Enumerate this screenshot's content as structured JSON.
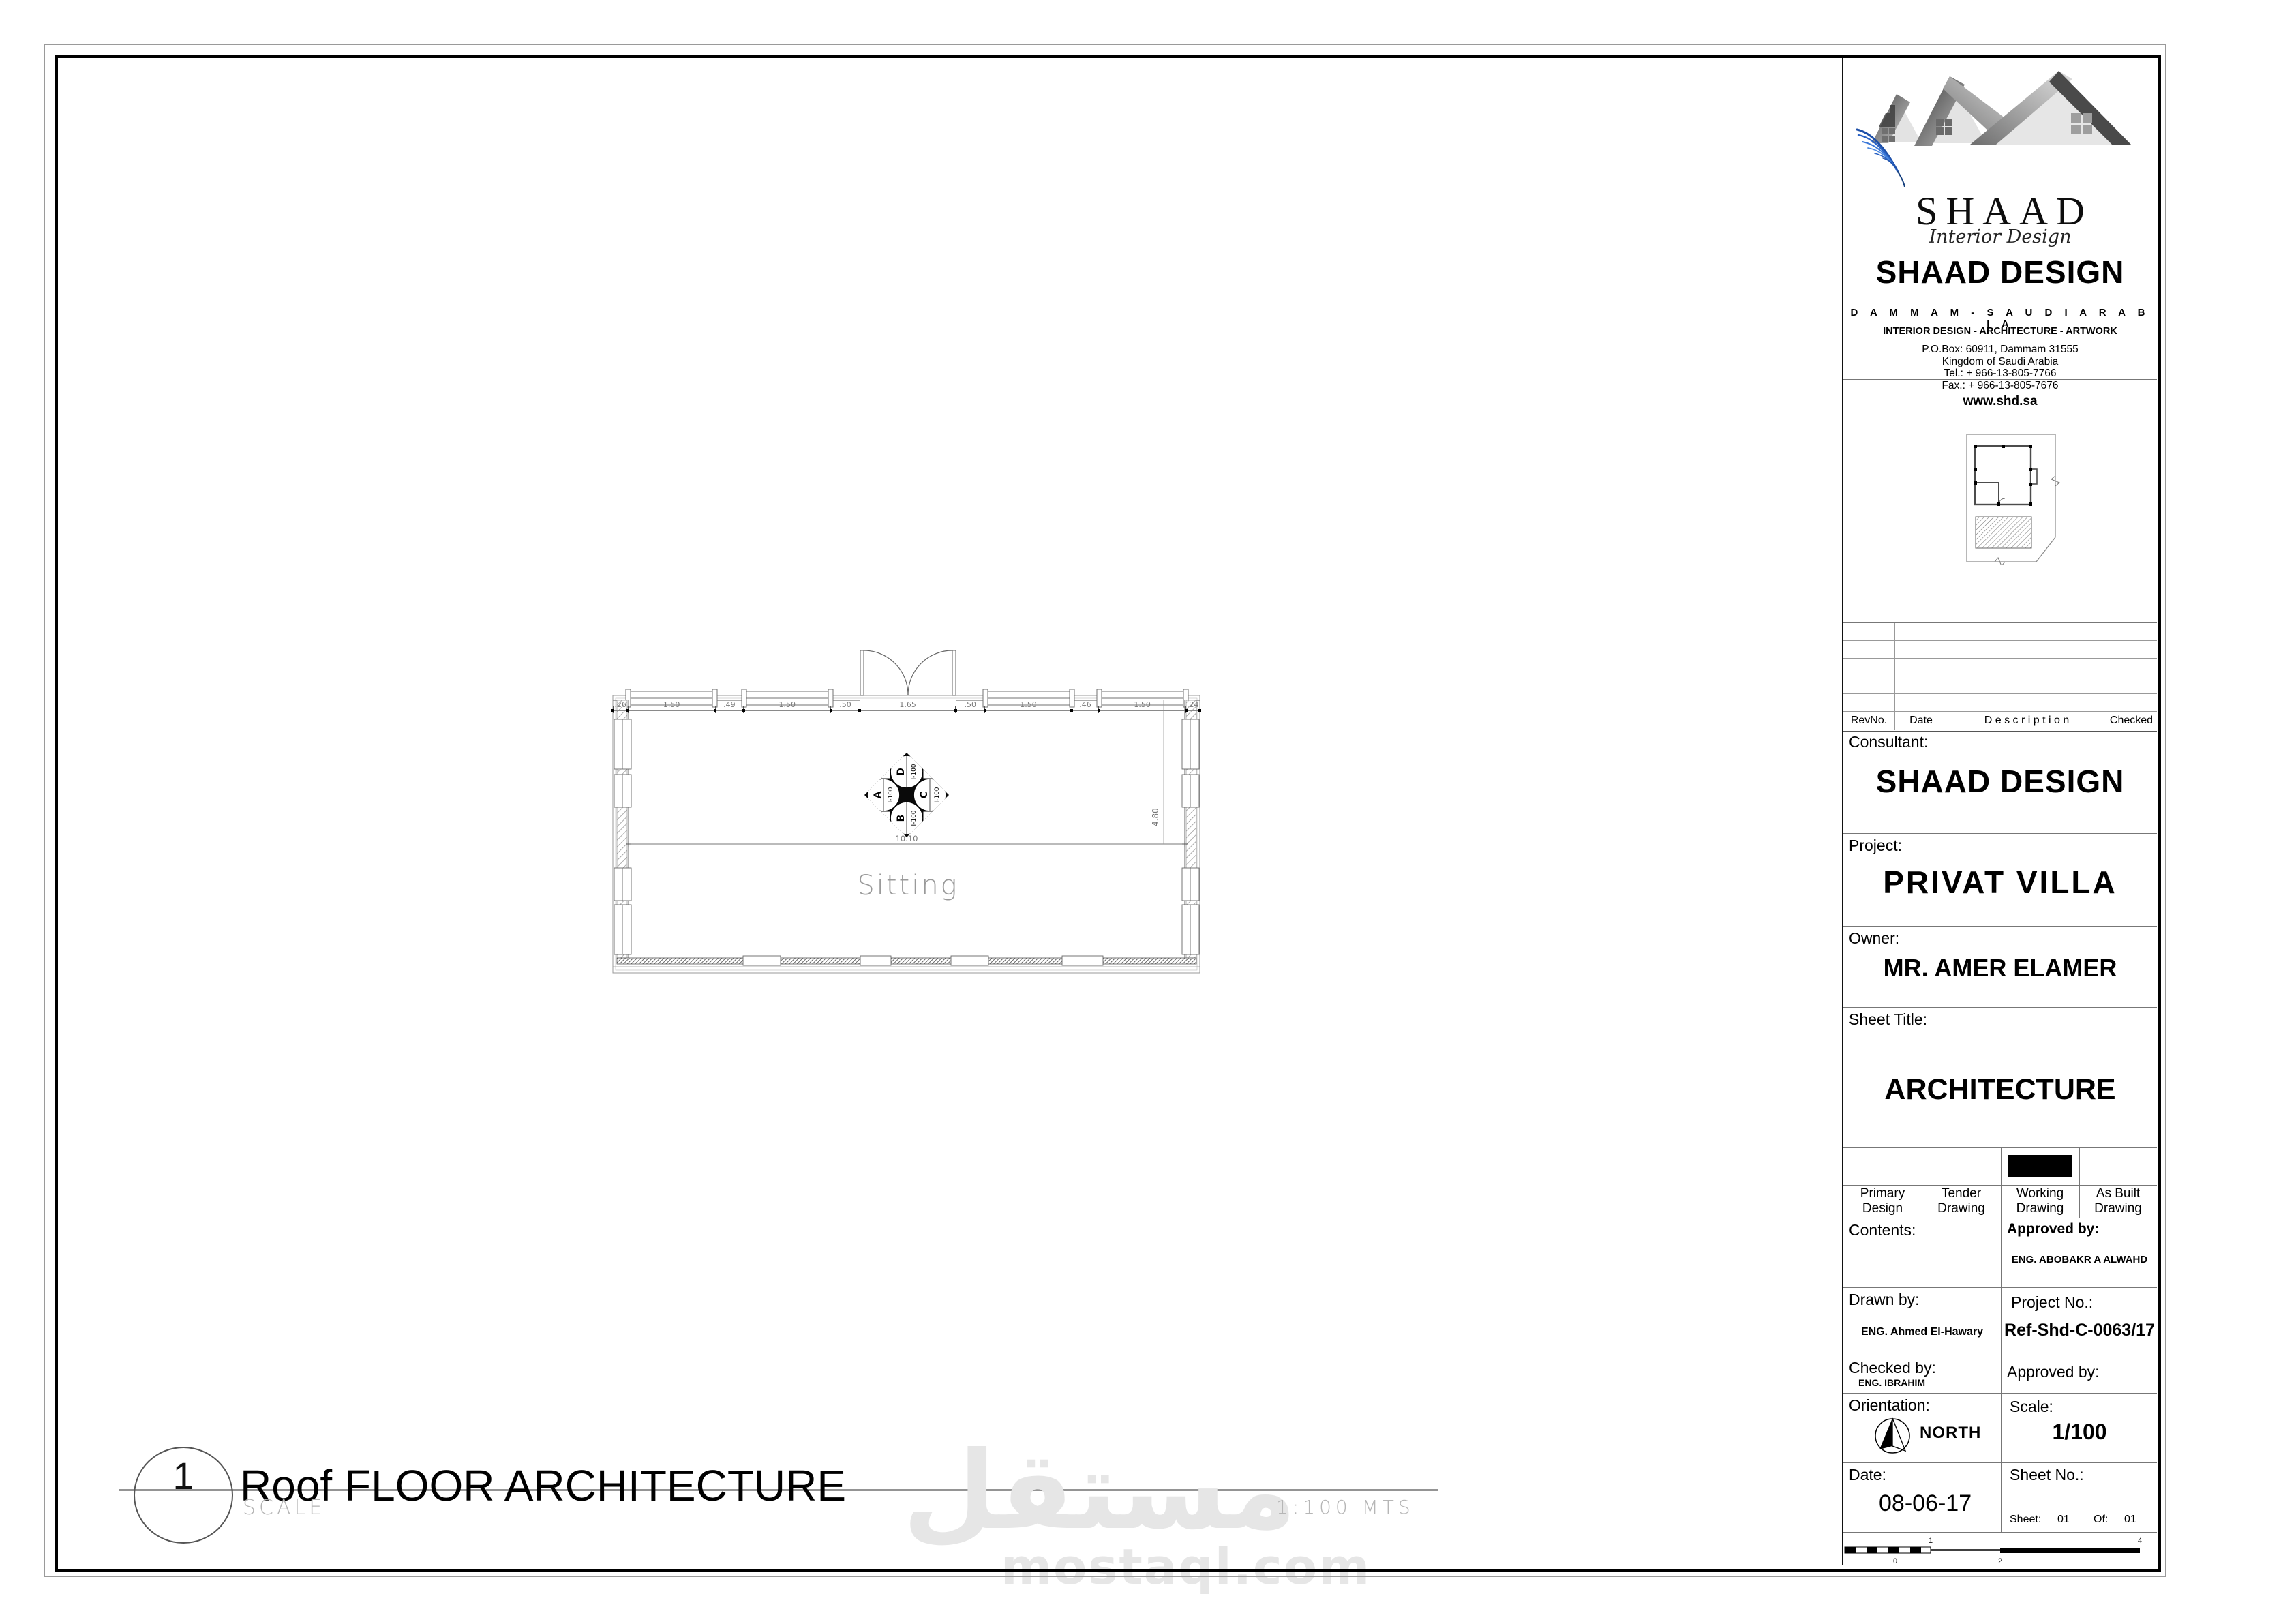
{
  "company": {
    "logo_text": "SHAAD",
    "logo_subtitle": "Interior Design",
    "name": "SHAAD DESIGN",
    "location": "D A M M A M - S A U D I   A R A B I A",
    "services": "INTERIOR DESIGN - ARCHITECTURE - ARTWORK",
    "address_line1": "P.O.Box: 60911, Dammam 31555",
    "address_line2": "Kingdom of Saudi Arabia",
    "address_line3": "Tel.: + 966-13-805-7766",
    "address_line4": "Fax.: + 966-13-805-7676",
    "website": "www.shd.sa"
  },
  "revision_table": {
    "headers": [
      "RevNo.",
      "Date",
      "D e s c r i p t i o n",
      "Checked"
    ]
  },
  "titleblock": {
    "consultant_label": "Consultant:",
    "consultant": "SHAAD DESIGN",
    "project_label": "Project:",
    "project": "PRIVAT VILLA",
    "owner_label": "Owner:",
    "owner": "MR. AMER ELAMER",
    "sheet_title_label": "Sheet Title:",
    "sheet_title": "ARCHITECTURE",
    "drawing_types": [
      "Primary Design",
      "Tender Drawing",
      "Working Drawing",
      "As Built Drawing"
    ],
    "selected_drawing_type": "Working Drawing",
    "contents_label": "Contents:",
    "approved_by_label": "Approved by:",
    "approved_by": "ENG. ABOBAKR A ALWAHD",
    "drawn_by_label": "Drawn by:",
    "drawn_by": "ENG. Ahmed El-Hawary",
    "project_no_label": "Project No.:",
    "project_no": "Ref-Shd-C-0063/17",
    "checked_by_label": "Checked by:",
    "checked_by": "ENG. IBRAHIM",
    "approved_by2_label": "Approved by:",
    "orientation_label": "Orientation:",
    "orientation": "NORTH",
    "scale_label": "Scale:",
    "scale": "1/100",
    "date_label": "Date:",
    "date": "08-06-17",
    "sheet_no_label": "Sheet No.:",
    "sheet_label": "Sheet:",
    "sheet_number": "01",
    "of_label": "Of:",
    "of_number": "01",
    "scalebar_labels": [
      "0",
      "1",
      "2",
      "4"
    ]
  },
  "drawing": {
    "view_number": "1",
    "title": "Roof FLOOR ARCHITECTURE",
    "scale_caption": "SCALE",
    "scale_note": "1:100  MTS"
  },
  "plan": {
    "room_label": "Sitting",
    "total_width": "10.10",
    "right_dim": "4.80",
    "top_dims": [
      ".26",
      "1.50",
      ".49",
      "1.50",
      ".50",
      "1.65",
      ".50",
      "1.50",
      ".46",
      "1.50",
      ".24"
    ],
    "section_marker": {
      "top": {
        "letter": "D",
        "ref": "I-100"
      },
      "left": {
        "letter": "A",
        "ref": "I-100"
      },
      "right": {
        "letter": "C",
        "ref": "I-100"
      },
      "bottom": {
        "letter": "B",
        "ref": "I-100"
      }
    }
  },
  "watermark": {
    "arabic": "مستقل",
    "latin": "mostaql.com"
  }
}
